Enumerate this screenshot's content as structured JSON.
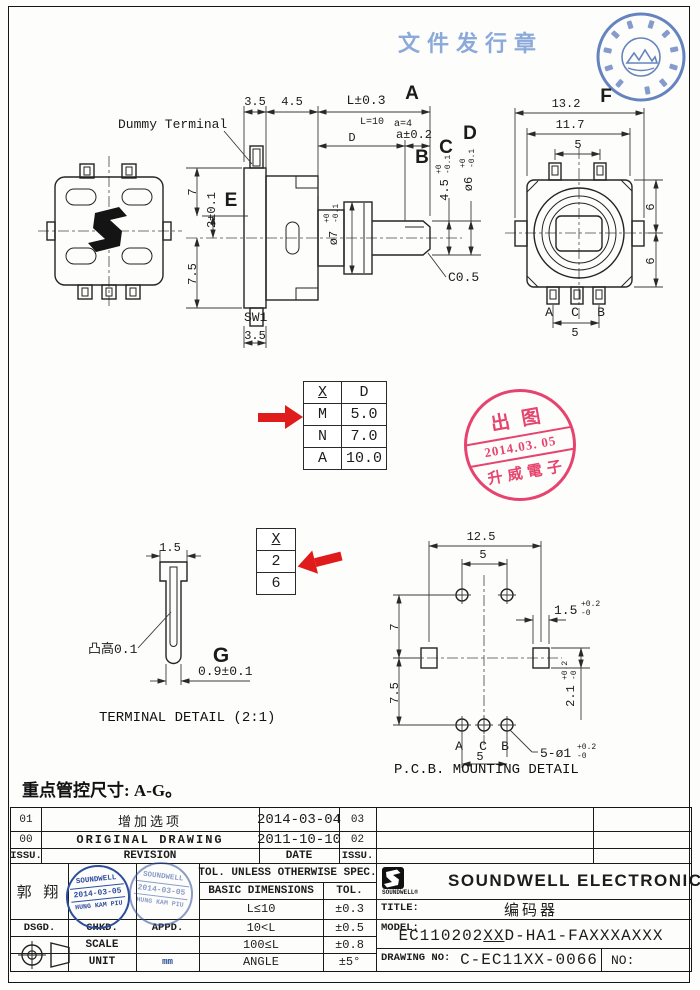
{
  "colors": {
    "stamp_blue": "#3f63ae",
    "stamp_red": "#e53562",
    "arrow_red": "#e01b1b",
    "ink": "#222222",
    "release_text_blue": "#7fa0d6"
  },
  "header": {
    "release_stamp_text": "文件发行章"
  },
  "side_view": {
    "dummy_terminal_label": "Dummy Terminal",
    "dim_plate": "3.5",
    "dim_body": "4.5",
    "dim_shaft_len": "L±0.3",
    "note_shaft_len": "L=10",
    "mark_a": "A",
    "dim_flat_pos": "D",
    "note_flat": "a=4",
    "dim_flat_len": "a±0.2",
    "mark_b": "B",
    "mark_c": "C",
    "dim_step": "4.5",
    "dim_step_hi": "+0",
    "dim_step_lo": "-0.1",
    "mark_d": "D",
    "dim_shaft_dia": "ø6",
    "dim_shaft_dia_hi": "+0",
    "dim_shaft_dia_lo": "-0.1",
    "dim_upper": "7",
    "dim_offset": "2±0.1",
    "mark_e": "E",
    "dim_lower": "7.5",
    "dim_bushing_dia": "ø7",
    "dim_bushing_hi": "+0",
    "dim_bushing_lo": "-0.1",
    "chamfer_note": "C0.5",
    "switch_label": "SW1",
    "dim_switch": "3.5"
  },
  "rear_view": {
    "dim_overall": "13.2",
    "mark_f": "F",
    "dim_body": "11.7",
    "dim_pin_top": "5",
    "dim_upper": "6",
    "dim_lower": "6",
    "pin_a": "A",
    "pin_c": "C",
    "pin_b": "B",
    "dim_pin_bottom": "5"
  },
  "xd_table": {
    "header_x": "X",
    "header_d": "D",
    "rows": [
      {
        "x": "M",
        "d": "5.0"
      },
      {
        "x": "N",
        "d": "7.0"
      },
      {
        "x": "A",
        "d": "10.0"
      }
    ]
  },
  "x26_table": {
    "header": "X",
    "row1": "2",
    "row2": "6"
  },
  "release_stamp": {
    "top": "出图",
    "date": "2014.03. 05",
    "bottom": "升威電子"
  },
  "terminal_detail": {
    "dim_width": "1.5",
    "bump_note": "凸高0.1",
    "mark_g": "G",
    "dim_tip": "0.9±0.1",
    "caption": "TERMINAL DETAIL (2:1)"
  },
  "pcb_detail": {
    "dim_slot_span": "12.5",
    "dim_hole_top": "5",
    "dim_upper": "7",
    "dim_lower": "7.5",
    "dim_slot_w": "1.5",
    "dim_slot_w_hi": "+0.2",
    "dim_slot_w_lo": "-0",
    "dim_slot_h": "2.1",
    "dim_slot_h_hi": "+0.2",
    "dim_slot_h_lo": "-0",
    "pin_a": "A",
    "pin_c": "C",
    "pin_b": "B",
    "dim_hole_bottom": "5",
    "hole_callout": "5-ø1",
    "hole_callout_hi": "+0.2",
    "hole_callout_lo": "-0",
    "caption": "P.C.B. MOUNTING DETAIL"
  },
  "control_note": "重点管控尺寸: A-G。",
  "revision_table": {
    "rows": [
      {
        "no": "01",
        "desc": "增加选项",
        "date": "2014-03-04",
        "issue": "03"
      },
      {
        "no": "00",
        "desc": "ORIGINAL DRAWING",
        "date": "2011-10-10",
        "issue": "02"
      }
    ],
    "header": {
      "no": "ISSU.",
      "desc": "REVISION",
      "date": "DATE",
      "issue": "ISSU."
    }
  },
  "approval_stamp": {
    "line1": "SOUNDWELL",
    "line2": "2014-03-05",
    "line3": "HUNG KAM PIU"
  },
  "title_block": {
    "designer": "郭 翔",
    "dsgd": "DSGD.",
    "chkd": "CHKD.",
    "appd": "APPD.",
    "scale": "SCALE",
    "unit": "UNIT",
    "unit_value": "mm",
    "tol_header": "TOL. UNLESS OTHERWISE SPEC.",
    "basic_dim": "BASIC DIMENSIONS",
    "tol": "TOL.",
    "tol_rows": [
      {
        "range": "L≤10",
        "tol": "±0.3"
      },
      {
        "range": "10<L",
        "tol": "±0.5"
      },
      {
        "range": "100≤L",
        "tol": "±0.8"
      },
      {
        "range": "ANGLE",
        "tol": "±5°"
      }
    ],
    "logo_text": "SOUNDWELL",
    "reg": "®",
    "company": "SOUNDWELL ELECTRONICS",
    "title_label": "TITLE:",
    "title_value": "编码器",
    "model_label": "MODEL:",
    "model_pre": "EC110202",
    "model_xx": "XX",
    "model_post": "D-HA1-FAXXXAXXX",
    "dwg_label": "DRAWING NO:",
    "dwg_value": "C-EC11XX-0066",
    "no_label": "NO:"
  }
}
